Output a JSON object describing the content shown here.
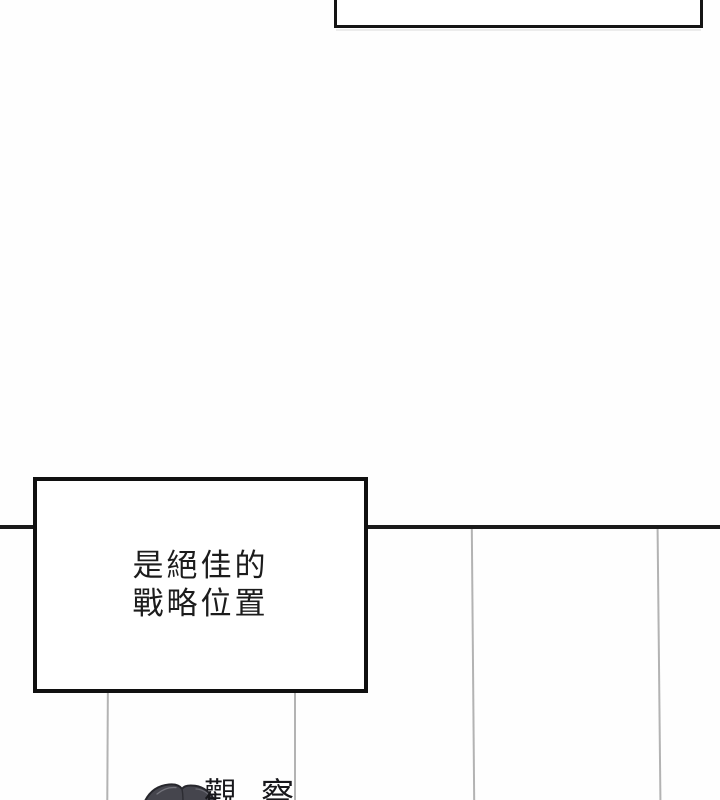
{
  "page": {
    "kind": "comic-panel-page",
    "background_color": "#fefefe"
  },
  "colors": {
    "panel_border": "#141414",
    "divider_line": "#1a1a1a",
    "background_wall_line": "#b3b3b3",
    "caption_text": "#1c1c1c",
    "hair_fill": "#45454d",
    "hair_outline": "#26262c"
  },
  "top_caption_box": {
    "text": ""
  },
  "caption_box": {
    "line1": "是絕佳的",
    "line2": "戰略位置"
  },
  "bottom": {
    "partial_text": "觀察"
  }
}
